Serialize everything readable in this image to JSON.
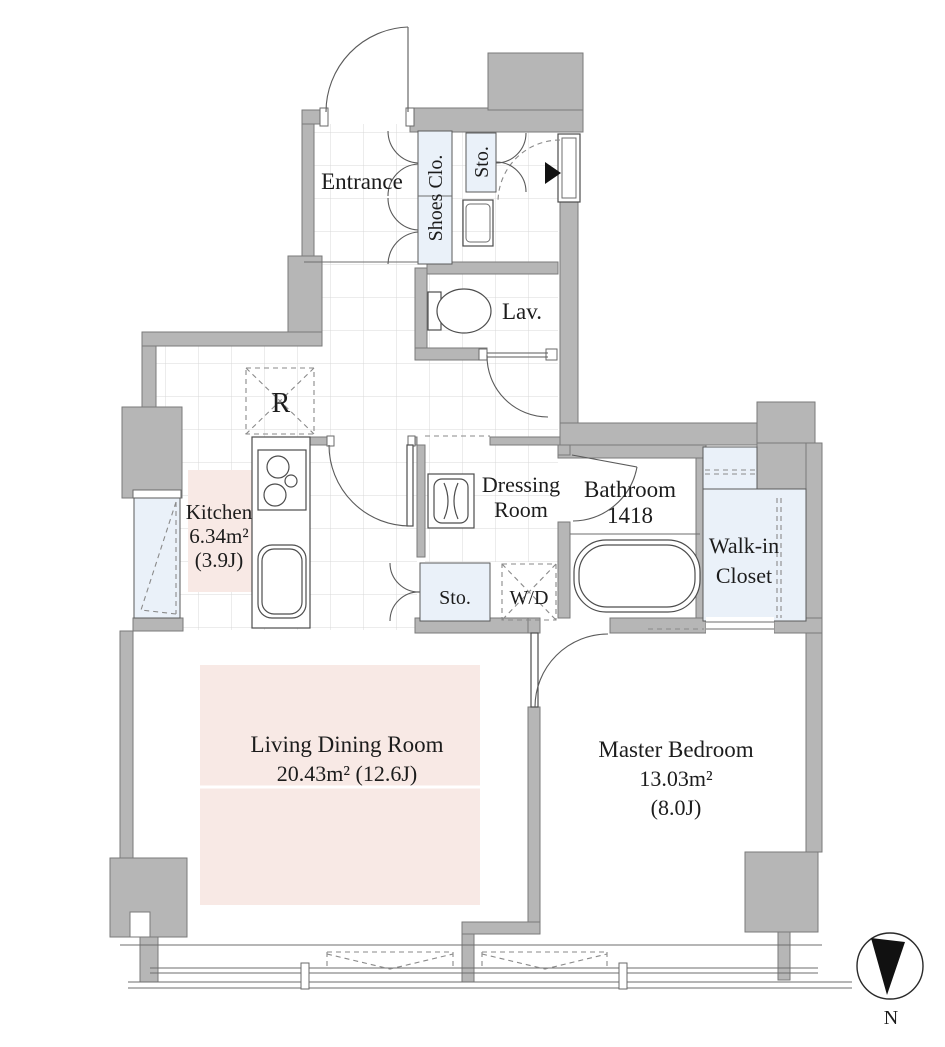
{
  "colors": {
    "wall": "#b6b6b6",
    "wall_edge": "#7a7a7a",
    "closet_fill": "#eaf1f9",
    "accent_pink": "#f8e9e5",
    "line": "#4d4d4d",
    "grid": "#d9d9d9",
    "compass_black": "#111111"
  },
  "rooms": {
    "entrance": {
      "label": "Entrance"
    },
    "shoes_closet": {
      "label": "Shoes Clo."
    },
    "storage_entrance": {
      "label": "Sto."
    },
    "lavatory": {
      "label": "Lav."
    },
    "refrigerator": {
      "label": "R"
    },
    "kitchen": {
      "label": "Kitchen",
      "area_m2": "6.34m²",
      "area_tatami": "(3.9J)"
    },
    "dressing_room": {
      "label_line1": "Dressing",
      "label_line2": "Room"
    },
    "bathroom": {
      "label": "Bathroom",
      "size_code": "1418"
    },
    "storage_hall": {
      "label": "Sto."
    },
    "washer_dryer": {
      "label": "W/D"
    },
    "walk_in_closet": {
      "label_line1": "Walk-in",
      "label_line2": "Closet"
    },
    "living_dining": {
      "label": "Living Dining Room",
      "area": "20.43m² (12.6J)"
    },
    "master_bedroom": {
      "label": "Master Bedroom",
      "area_m2": "13.03m²",
      "area_tatami": "(8.0J)"
    }
  },
  "compass": {
    "label": "N"
  }
}
